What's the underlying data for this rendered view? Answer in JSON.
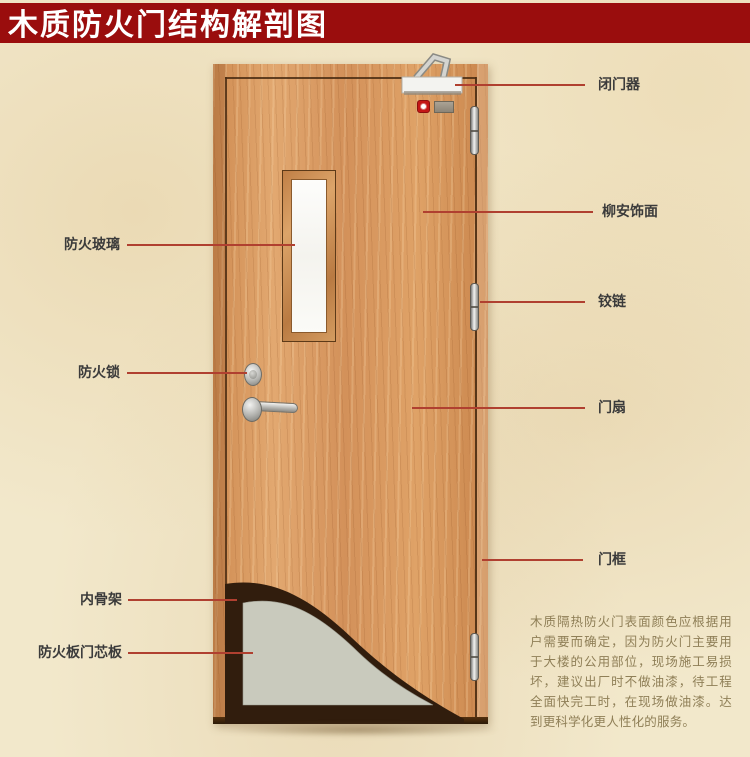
{
  "banner": {
    "title": "木质防火门结构解剖图"
  },
  "annotations": {
    "left": [
      {
        "id": "fire-glass",
        "text": "防火玻璃"
      },
      {
        "id": "fire-lock",
        "text": "防火锁"
      },
      {
        "id": "inner-skeleton",
        "text": "内骨架"
      },
      {
        "id": "fire-core-board",
        "text": "防火板门芯板"
      }
    ],
    "right": [
      {
        "id": "door-closer",
        "text": "闭门器"
      },
      {
        "id": "lauan-veneer",
        "text": "柳安饰面"
      },
      {
        "id": "hinge",
        "text": "铰链"
      },
      {
        "id": "door-leaf",
        "text": "门扇"
      },
      {
        "id": "door-frame",
        "text": "门框"
      }
    ]
  },
  "note": {
    "text": "木质隔热防火门表面颜色应根据用户需要而确定，因为防火门主要用于大楼的公用部位，现场施工易损坏，建议出厂时不做油漆，待工程全面快完工时，在现场做油漆。达到更科学化更人性化的服务。"
  },
  "colors": {
    "banner_red": "#9a0d0d",
    "annotation_line_red": "#b04030",
    "door_wood": "#d89a60",
    "core_board_gray": "#c9cabd",
    "skeleton_dark": "#311d0d",
    "note_text": "#8f7f57",
    "background_paper": "#f2e8cb"
  }
}
